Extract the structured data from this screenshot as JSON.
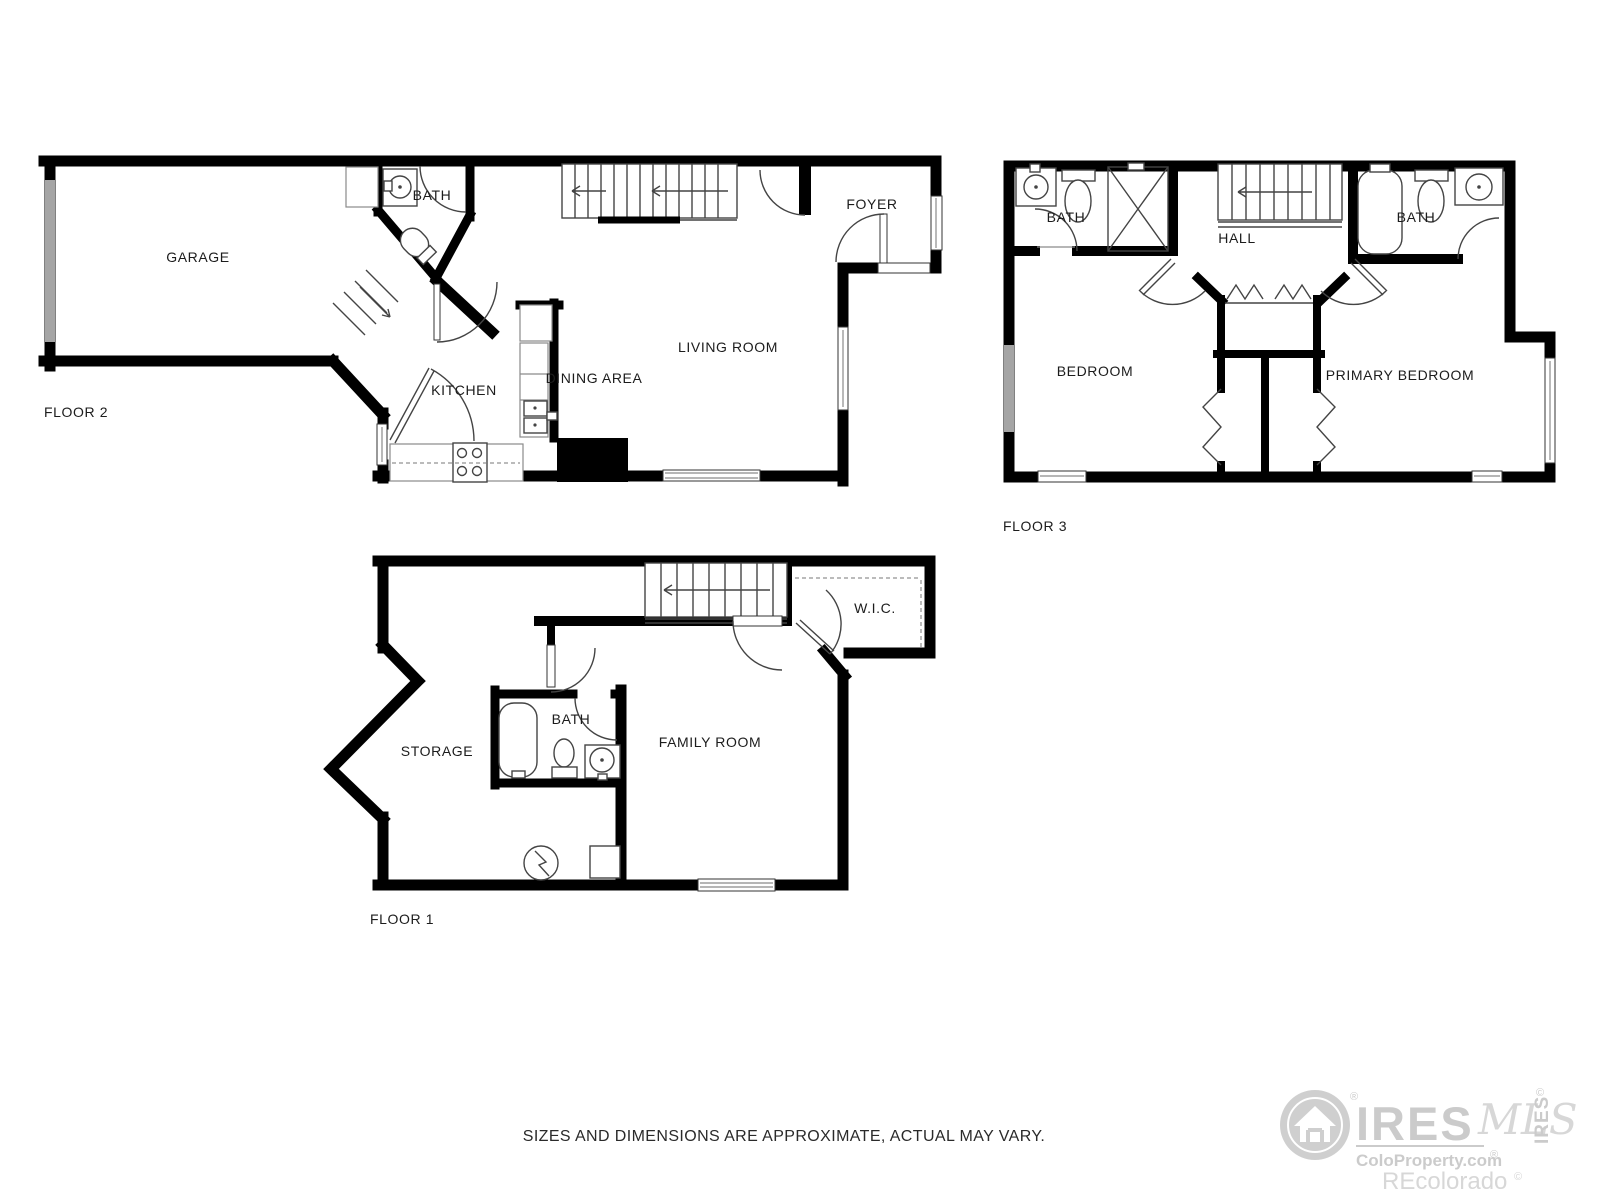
{
  "footer": {
    "disclaimer": "SIZES AND DIMENSIONS ARE APPROXIMATE, ACTUAL MAY VARY."
  },
  "floors": {
    "floor2": {
      "label": "FLOOR 2",
      "garage": "GARAGE",
      "bath": "BATH",
      "kitchen": "KITCHEN",
      "dining": "DINING AREA",
      "living": "LIVING ROOM",
      "foyer": "FOYER"
    },
    "floor3": {
      "label": "FLOOR 3",
      "bath_left": "BATH",
      "bath_right": "BATH",
      "hall": "HALL",
      "bedroom": "BEDROOM",
      "primary_bedroom": "PRIMARY BEDROOM"
    },
    "floor1": {
      "label": "FLOOR 1",
      "storage": "STORAGE",
      "bath": "BATH",
      "family_room": "FAMILY ROOM",
      "wic": "W.I.C."
    }
  },
  "watermark": {
    "brand": "IRES",
    "script": "MLS",
    "registered": "®",
    "site": "ColoProperty.com",
    "site_mark": "®",
    "recolorado": "REcolorado",
    "recolorado_mark": "©",
    "side_mark": "©",
    "side_brand": "IRES"
  },
  "colors": {
    "wall": "#000000",
    "fixture_line": "#444444",
    "counter_line": "#8a8a8a",
    "window_gray": "#a5a5a5",
    "label_text": "#1c1c1c",
    "watermark_gray": "#c9c9c9"
  }
}
